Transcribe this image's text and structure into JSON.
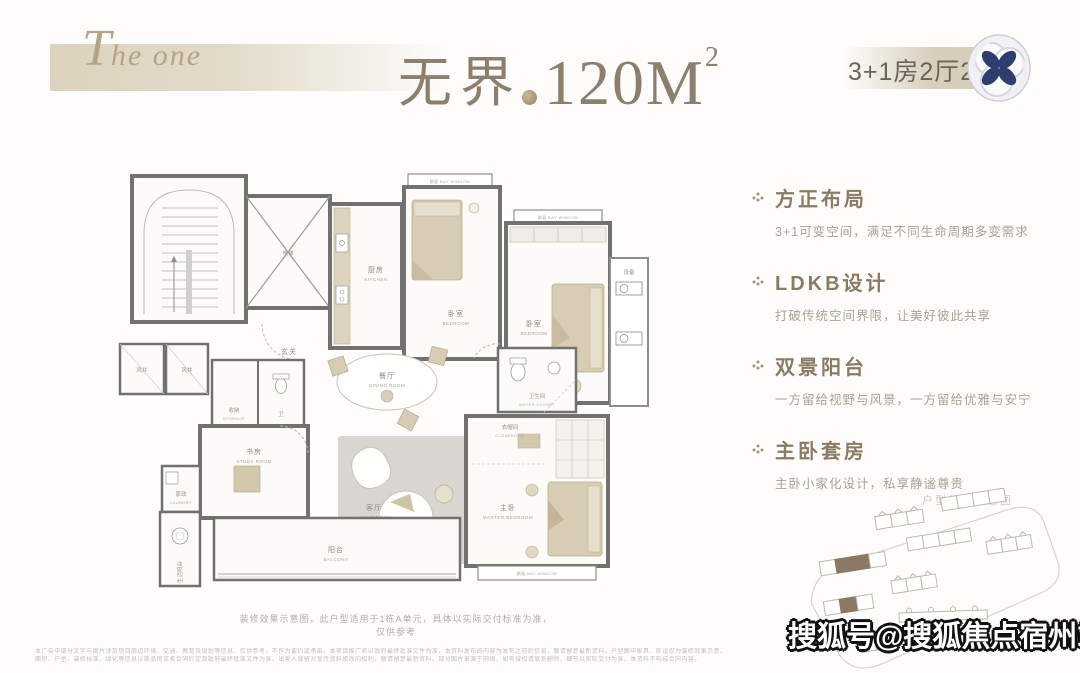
{
  "header": {
    "brand": "The one",
    "title": "无界",
    "area": "120M",
    "area_sup": "2",
    "spec": "3+1房2厅2卫"
  },
  "features": [
    {
      "title": "方正布局",
      "desc": "3+1可变空间，满足不同生命周期多变需求"
    },
    {
      "title": "LDKB设计",
      "desc": "打破传统空间界限，让美好彼此共享"
    },
    {
      "title": "双景阳台",
      "desc": "一方留给视野与风景，一方留给优雅与安宁"
    },
    {
      "title": "主卧套房",
      "desc": "主卧小家化设计，私享静谧尊贵"
    }
  ],
  "plan": {
    "caption": "装修效果示意图，此户型适用于1栋A单元，具体以实际交付标准为准，仅供参考",
    "rooms": {
      "elevator": "电梯",
      "anteroom_cn": "玄关",
      "anteroom_en": "ANTEROOM",
      "kitchen_cn": "厨房",
      "kitchen_en": "KITCHEN",
      "bedroom1_cn": "卧室",
      "bedroom1_en": "BEDROOM",
      "bedroom2_cn": "卧室",
      "bedroom2_en": "BEDROOM",
      "bay": "飘窗 BAY WINDOW",
      "equipment": "设备",
      "shaft": "风井",
      "storage_cn": "收纳",
      "storage_en": "STORAGE",
      "bath_small": "卫",
      "dining_cn": "餐厅",
      "dining_en": "DINING ROOM",
      "wc_cn": "卫生间",
      "wc_en": "WATER CLOSET",
      "living_cn": "客厅",
      "living_en": "LIVING ROOM",
      "cloak_cn": "衣帽间",
      "cloak_en": "CLOAKROOM",
      "master_cn": "主卧",
      "master_en": "MASTER BEDROOM",
      "study_cn": "书房",
      "study_en": "STUDY ROOM",
      "balcony_cn": "阳台",
      "balcony_en": "BALCONY",
      "laundry_cn": "家政",
      "laundry_en": "LAUNDRY",
      "service_balcony": "生活阳台"
    }
  },
  "siteplan": {
    "label": "户型位置示意图"
  },
  "watermark": "搜狐号@搜狐焦点宿州站",
  "disclaimer": {
    "line1": "本广告中部分文字与图片涉及项目周边环境、交通、教育及规划等信息，仅供参考，不作为要约或承诺。本项目推广名以政府最终批准文件为准，本资料发布的内容为发布之前的信息，敬请留意最新资料。户型图中家具、陈设仅为装修效果示意。",
    "line2": "面积、户型、装修标准、绿化等信息以商品房买卖合同约定及政府最终批准文件为准。出卖人保留对宣传资料修改的权利，敬请留意最新资料。部分图片来源于网络，如有侵权请联系删除，细节以实际交付为准。本资料不构成合同内容。"
  },
  "colors": {
    "accent_beige": "#dcd2be",
    "title_brown": "#8d7f6d",
    "feature_title": "#8b7a64",
    "feature_desc": "#aba195",
    "logo_navy": "#2f3d6c",
    "wall_gray": "#717171",
    "furniture_beige": "#d7cdb4",
    "site_highlight": "#8d7863"
  }
}
